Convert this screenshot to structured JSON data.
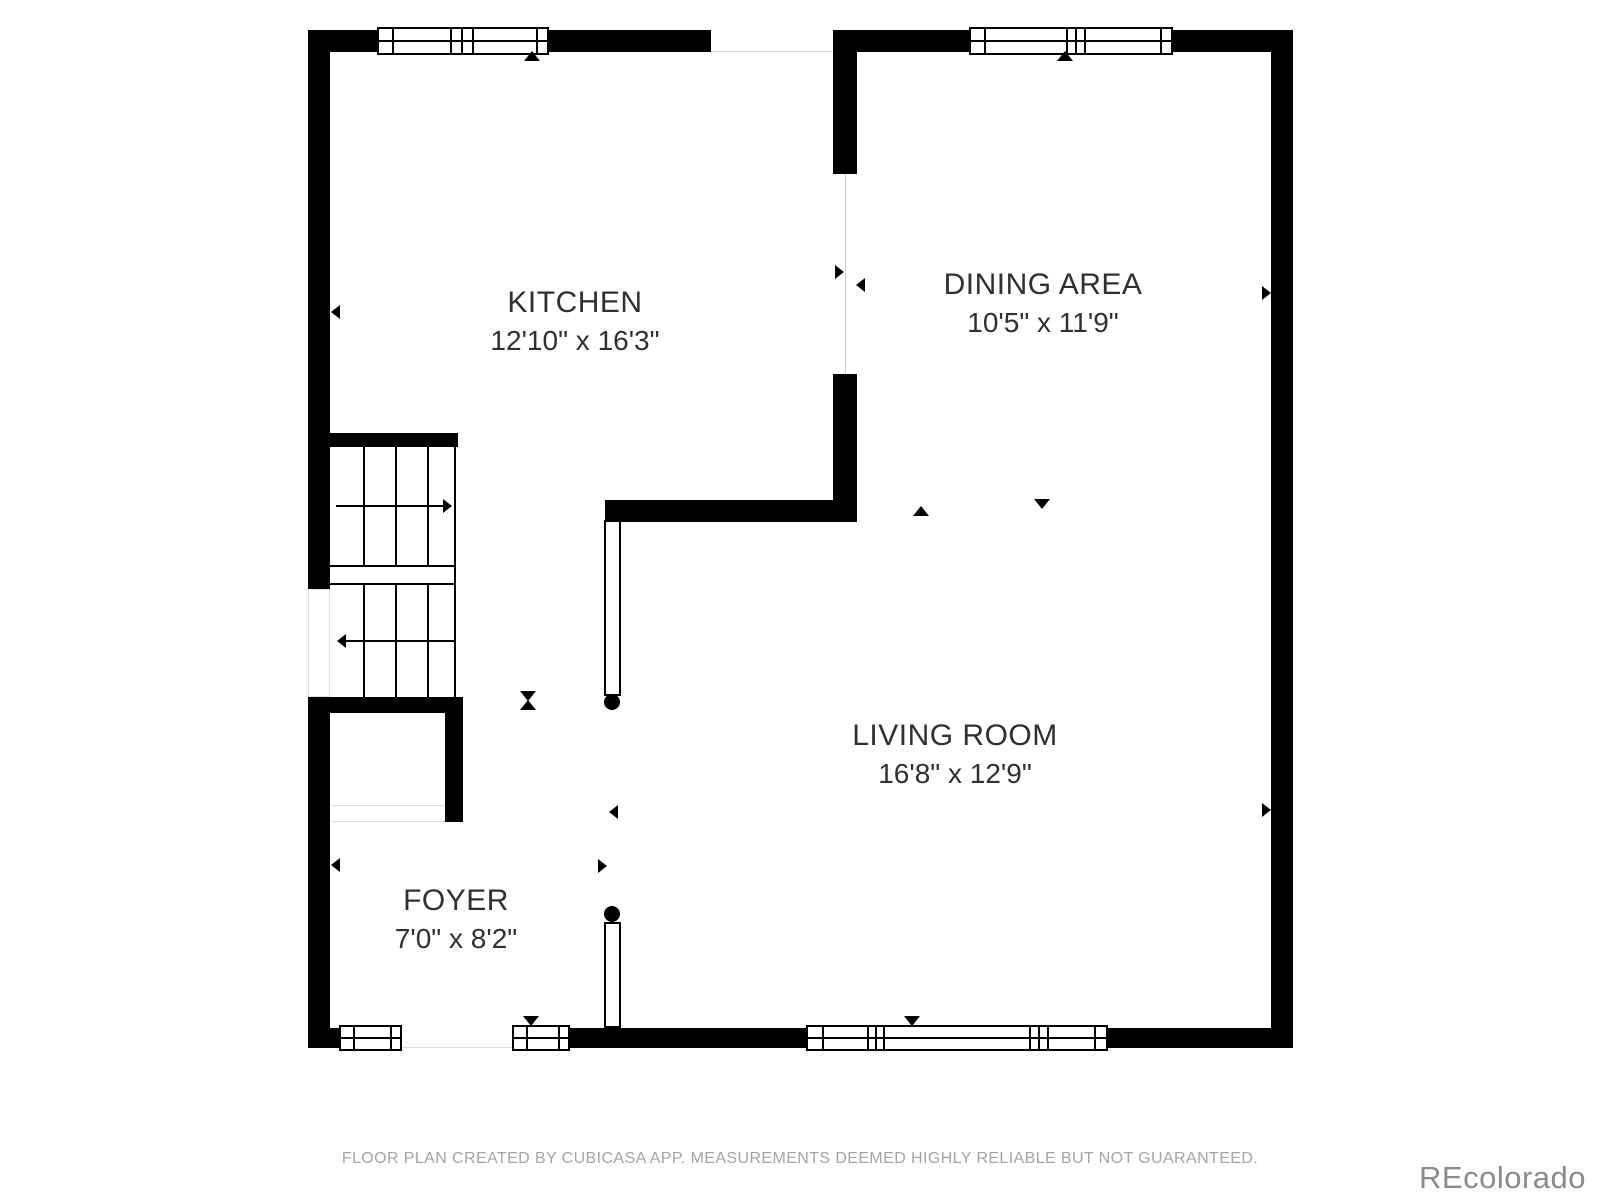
{
  "floor_plan": {
    "rooms": [
      {
        "name": "KITCHEN",
        "dimensions": "12'10\" x 16'3\""
      },
      {
        "name": "DINING AREA",
        "dimensions": "10'5\" x 11'9\""
      },
      {
        "name": "LIVING ROOM",
        "dimensions": "16'8\" x 12'9\""
      },
      {
        "name": "FOYER",
        "dimensions": "7'0\" x 8'2\""
      }
    ],
    "icons": {
      "direction_marker": "small black triangle",
      "door_hinge_dot": "black filled circle",
      "stair_direction": "long arrow across stair treads"
    }
  },
  "footer": {
    "disclaimer": "FLOOR PLAN CREATED BY CUBICASA APP. MEASUREMENTS DEEMED HIGHLY RELIABLE BUT NOT GUARANTEED."
  },
  "watermark": {
    "text": "REcolorado"
  },
  "colors": {
    "wall": "#000000",
    "bg": "#ffffff",
    "label_text": "#303030",
    "footer_text": "#a4a4a4",
    "watermark_text": "#8b8b8b"
  }
}
